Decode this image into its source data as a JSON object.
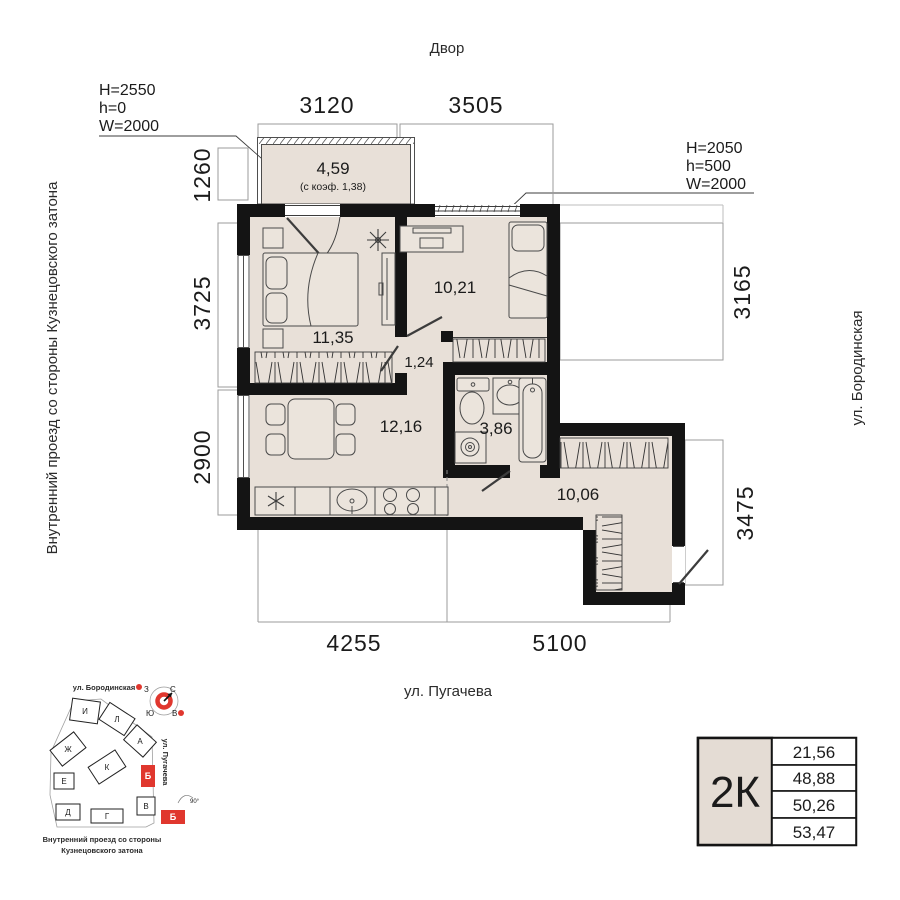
{
  "labels": {
    "courtyard": "Двор",
    "street_left": "Внутренний проезд со стороны Кузнецовского затона",
    "street_right": "ул. Бородинская",
    "street_bottom": "ул. Пугачева"
  },
  "annotation_left": {
    "line1": "H=2550",
    "line2": "h=0",
    "line3": "W=2000"
  },
  "annotation_right": {
    "line1": "H=2050",
    "line2": "h=500",
    "line3": "W=2000"
  },
  "dimensions": {
    "top": [
      "3120",
      "3505"
    ],
    "left": [
      "1260",
      "3725",
      "2900"
    ],
    "right": [
      "3165",
      "3475"
    ],
    "bottom": [
      "4255",
      "5100"
    ]
  },
  "rooms": {
    "balcony_area": "4,59",
    "balcony_coef": "(с коэф. 1,38)",
    "bedroom": "11,35",
    "bedroom2": "10,21",
    "hall": "1,24",
    "kitchen_living": "12,16",
    "bathroom": "3,86",
    "hallway": "10,06"
  },
  "minimap": {
    "street_top": "ул. Бородинская",
    "street_right": "ул. Пугачева",
    "caption_line1": "Внутренний проезд со стороны",
    "caption_line2": "Кузнецовского затона",
    "angle_note": "90°",
    "buildings": {
      "i": "И",
      "l": "Л",
      "a": "А",
      "zh": "Ж",
      "k": "К",
      "e": "Е",
      "d": "Д",
      "g": "Г",
      "v": "В"
    },
    "highlight": "Б",
    "compass": {
      "north": "С",
      "south": "Ю",
      "west": "З",
      "east": "В"
    }
  },
  "summary": {
    "type": "2К",
    "rows": [
      "21,56",
      "48,88",
      "50,26",
      "53,47"
    ]
  },
  "colors": {
    "floor": "#e8e0d8",
    "wall": "#141414",
    "accent": "#e0372e",
    "dimline": "#9b9b9b"
  }
}
